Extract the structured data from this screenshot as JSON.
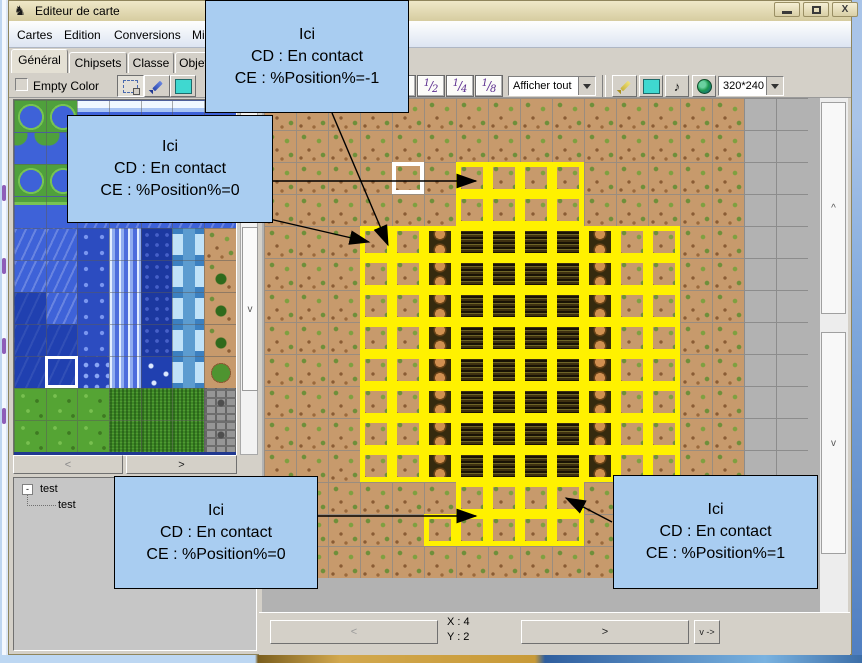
{
  "window": {
    "title": "Editeur de carte",
    "app_icon": "sprite-icon",
    "close_glyph": "X"
  },
  "menu": {
    "items": [
      "Cartes",
      "Edition",
      "Conversions",
      "Mi"
    ]
  },
  "tabs": {
    "items": [
      "Général",
      "Chipsets",
      "Classe",
      "Objets"
    ],
    "active": "Général"
  },
  "toolbar": {
    "empty_color_label": "Empty Color",
    "zoom_buttons": [
      {
        "num": "1",
        "den": "1"
      },
      {
        "num": "1",
        "den": "2"
      },
      {
        "num": "1",
        "den": "4"
      },
      {
        "num": "1",
        "den": "8"
      }
    ],
    "fraction_slash": "/",
    "display_dropdown_value": "Afficher tout",
    "resolution_dropdown_value": "320*240"
  },
  "palette": {
    "rows": [
      [
        "wgrass",
        "wgrass",
        "wcrest",
        "wcrest",
        "wcrest",
        "wcrest",
        "wcrest"
      ],
      [
        "wedge",
        "wedge",
        "water",
        "water",
        "water",
        "water",
        "water"
      ],
      [
        "wgrass",
        "wgrass",
        "water",
        "water",
        "water",
        "water",
        "water"
      ],
      [
        "wtop",
        "wtop",
        "water",
        "water",
        "water",
        "water",
        "water"
      ],
      [
        "water",
        "water",
        "wpat",
        "wfall",
        "wdark",
        "pillar",
        "dirt"
      ],
      [
        "water",
        "water",
        "wpat",
        "wfall",
        "wdark",
        "pillar",
        "dirtp"
      ],
      [
        "deep",
        "water",
        "wpat",
        "wfall",
        "wdark",
        "pillar",
        "dirtp"
      ],
      [
        "deep",
        "deep",
        "wpat",
        "wfall",
        "wdark",
        "pillar",
        "dirtp"
      ],
      [
        "deep",
        "deep",
        "wpat2",
        "wfall",
        "wsplash",
        "pillar",
        "dirtg"
      ],
      [
        "grass",
        "grass",
        "grass",
        "grassd",
        "grassd",
        "grassd",
        "stone"
      ],
      [
        "grass",
        "grass",
        "grass",
        "grassd",
        "grassd",
        "grassd",
        "stone"
      ]
    ],
    "selected_tile": {
      "col": 1,
      "row": 8
    },
    "nav_left": "<",
    "nav_right": ">",
    "scroll_down_glyph": "v"
  },
  "tree": {
    "expander_glyph": "-",
    "root_label": "test",
    "child_label": "test"
  },
  "map": {
    "legend": {
      ".": "dirt",
      "Y": "dirt-highlighted",
      "C": "crop-highlighted",
      "E": "crop-edge-highlighted",
      "g": "empty-void"
    },
    "rows": [
      "...............gg",
      "...............gg",
      "......YYYY.....gg",
      "......YYYY.....gg",
      "...YYECCCCEYY..gg",
      "...YYECCCCEYY..gg",
      "...YYECCCCEYY..gg",
      "...YYECCCCEYY..gg",
      "...YYECCCCEYY..gg",
      "...YYECCCCEYY..gg",
      "...YYECCCCEYY..gg",
      "...YYECCCCEYY..gg",
      "......YYYY.....gg",
      ".....YYYYY.....gg",
      "...............gg"
    ],
    "white_square": {
      "col": 4,
      "row": 2
    },
    "scroll_up_glyph": "^",
    "scroll_down_glyph": "v"
  },
  "statusbar": {
    "coord_x": "X : 4",
    "coord_y": "Y : 2",
    "nav_left": "<",
    "nav_right": ">",
    "corner_button": "v ->"
  },
  "callouts": [
    {
      "id": "top",
      "lines": [
        "Ici",
        "CD : En contact",
        "CE : %Position%=-1"
      ]
    },
    {
      "id": "left",
      "lines": [
        "Ici",
        "CD : En contact",
        "CE : %Position%=0"
      ]
    },
    {
      "id": "bottom-left",
      "lines": [
        "Ici",
        "CD : En contact",
        "CE : %Position%=0"
      ]
    },
    {
      "id": "bottom-right",
      "lines": [
        "Ici",
        "CD : En contact",
        "CE : %Position%=1"
      ]
    }
  ],
  "colors": {
    "highlight_yellow": "#FFF100",
    "callout_bg": "#A9CDF1",
    "callout_border": "#000000",
    "selection_white": "#FFFFFF",
    "titlebar_tan": "#D9D0A8",
    "fraction_purple": "#5B2D8E",
    "teal_swatch": "#3FD8D0"
  }
}
